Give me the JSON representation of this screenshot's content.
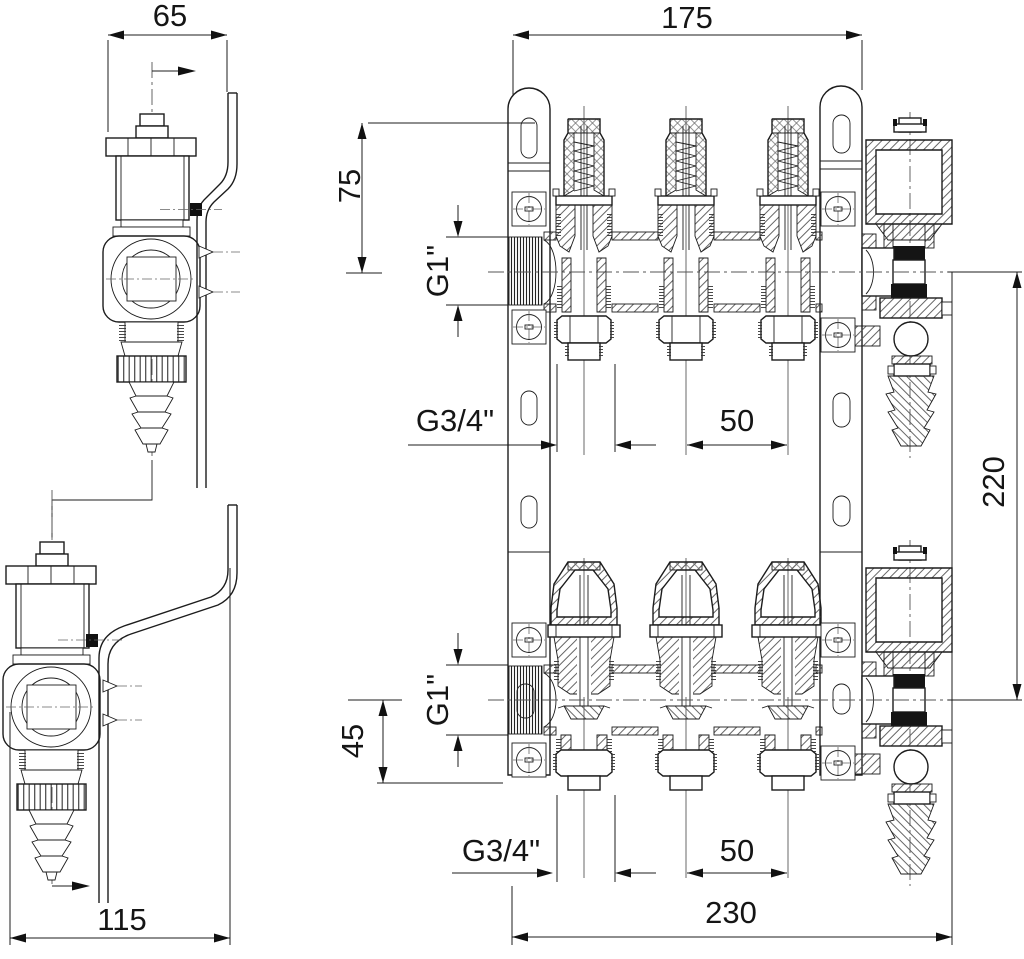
{
  "drawing": {
    "description": "Sectional assembly drawing of a 3-loop heating circuit manifold set (supply and return bars) with mounting brackets, valve inserts, air vent pots and drain valves with hose connectors",
    "views": {
      "side_top": "side view of supply manifold valve",
      "side_bottom": "side view of return manifold valve",
      "front_top": "sectional front view of supply manifold",
      "front_bottom": "sectional front view of return manifold"
    },
    "dimensions": {
      "side_top_depth": "65",
      "front_top_bracket_span": "175",
      "supply_axis_offset": "75",
      "supply_inlet_thread": "G1\"",
      "supply_outlet_thread": "G3/4\"",
      "supply_outlet_pitch": "50",
      "axis_to_axis_height": "220",
      "return_axis_offset": "45",
      "return_inlet_thread": "G1\"",
      "return_outlet_thread": "G3/4\"",
      "return_outlet_pitch": "50",
      "front_bottom_overall_width": "230",
      "side_bottom_depth": "115"
    }
  }
}
